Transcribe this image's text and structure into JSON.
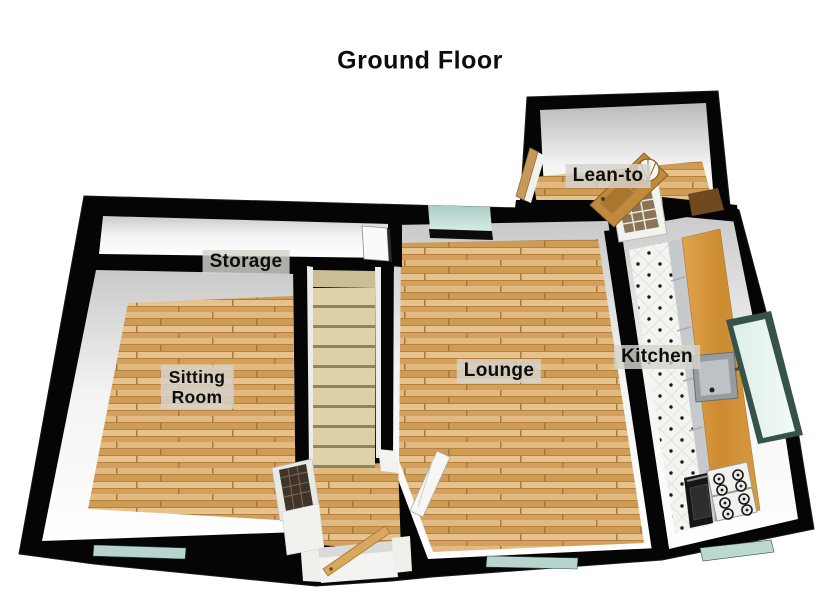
{
  "title": "Ground Floor",
  "rooms": [
    {
      "name": "storage",
      "label": "Storage"
    },
    {
      "name": "lean-to",
      "label": "Lean-to"
    },
    {
      "name": "sitting-room",
      "label": "Sitting Room",
      "lines": [
        "Sitting",
        "Room"
      ]
    },
    {
      "name": "lounge",
      "label": "Lounge"
    },
    {
      "name": "kitchen",
      "label": "Kitchen"
    }
  ],
  "palette": {
    "wall": "#000000",
    "wall_face": "#f2f2f2",
    "wood_floor": "#d9a761",
    "stair_tread": "#ded2a8",
    "window_glass": "#bcd8d1",
    "window_glass_pale": "#e6f3ec",
    "counter_wood": "#d0903a",
    "kitchen_tile": "#f4f4f1",
    "label_background": "#d5d3cd",
    "label_text": "#0d0d0d"
  }
}
